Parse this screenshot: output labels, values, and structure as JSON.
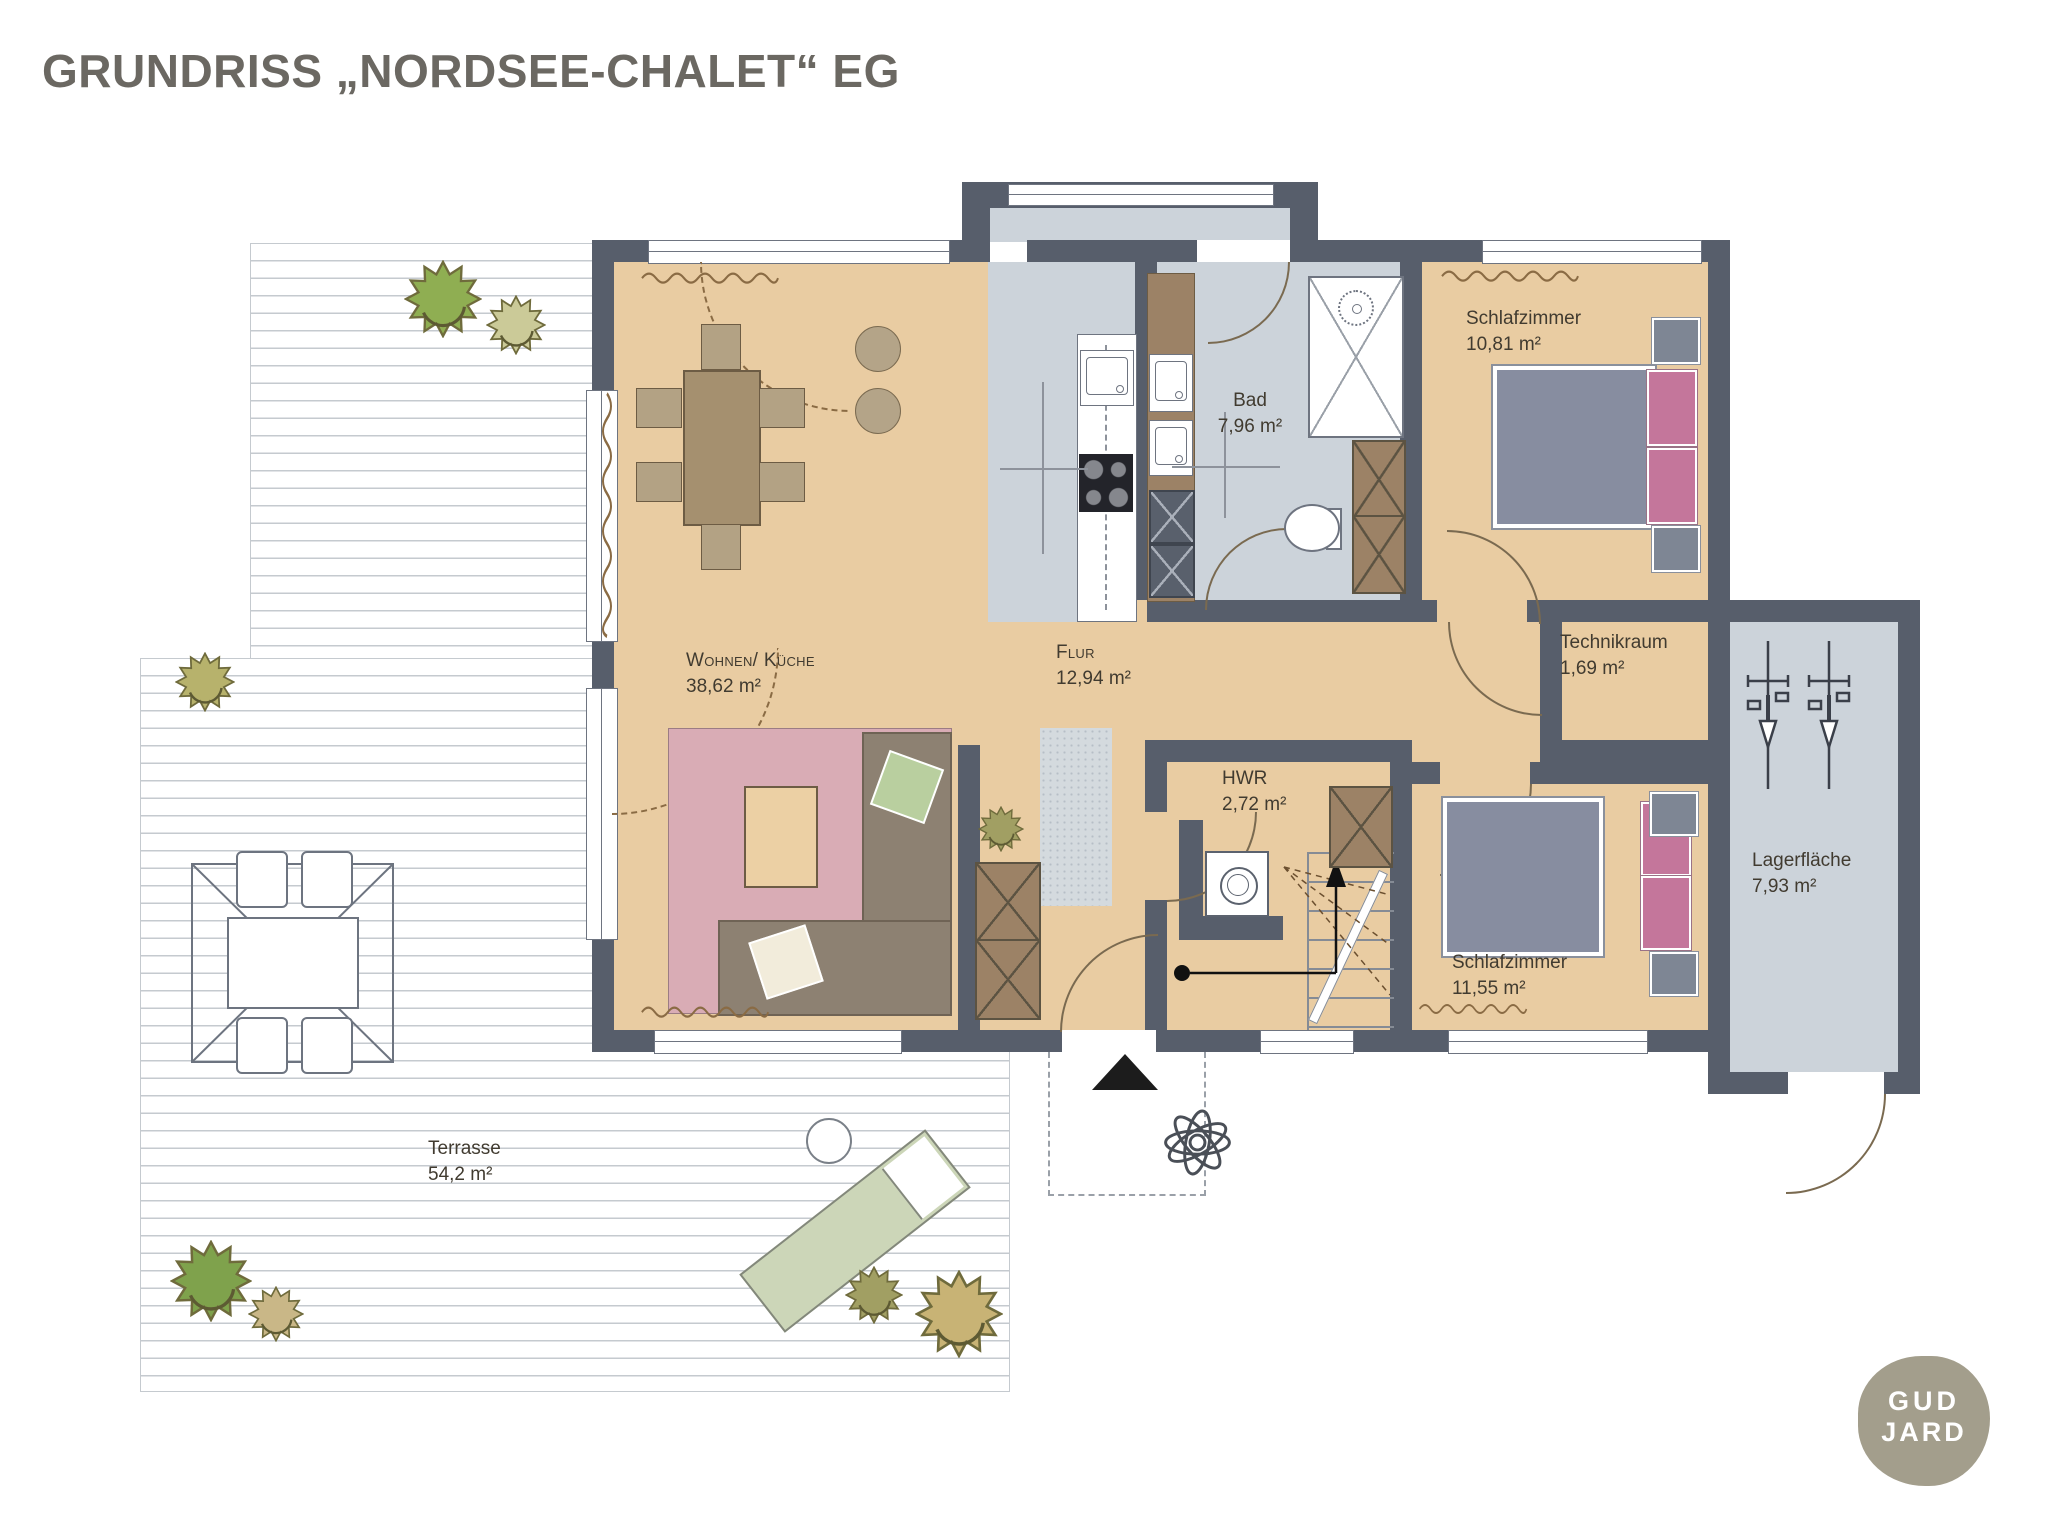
{
  "title": "GRUNDRISS „NORDSEE-CHALET“ EG",
  "logo": {
    "line1": "GUD",
    "line2": "JARD"
  },
  "rooms": {
    "living": {
      "name": "Wohnen/ Küche",
      "area": "38,62 m²"
    },
    "hall": {
      "name": "Flur",
      "area": "12,94 m²"
    },
    "bath": {
      "name": "Bad",
      "area": "7,96 m²"
    },
    "bedroom_top": {
      "name": "Schlafzimmer",
      "area": "10,81 m²"
    },
    "technik": {
      "name": "Technikraum",
      "area": "1,69 m²"
    },
    "hwr": {
      "name": "HWR",
      "area": "2,72 m²"
    },
    "bedroom_bottom": {
      "name": "Schlafzimmer",
      "area": "11,55 m²"
    },
    "storage": {
      "name": "Lagerfläche",
      "area": "7,93 m²"
    },
    "terrace": {
      "name": "Terrasse",
      "area": "54,2 m²"
    }
  },
  "colors": {
    "wall": "#575e6b",
    "floor": "#e9cca2",
    "wet": "#ccd3da",
    "cab": "#9c8266",
    "rug": "#d9acb5",
    "sofa": "#8d8172",
    "table": "#a5906f",
    "chair": "#b3a284",
    "bed": "#878da0",
    "pillow": "#c4769b",
    "stand": "#7e8694",
    "lounger": "#ccd6b8",
    "title": "#6b6862",
    "logo": "#a39e8c",
    "deckline": "#c5cacf",
    "curtain": "#8a6b44",
    "line": "#6e7480",
    "trees": [
      "#8fae52",
      "#cbca98",
      "#b7b26c",
      "#7fa24c",
      "#c9b787",
      "#a19f63",
      "#c8b375"
    ]
  }
}
